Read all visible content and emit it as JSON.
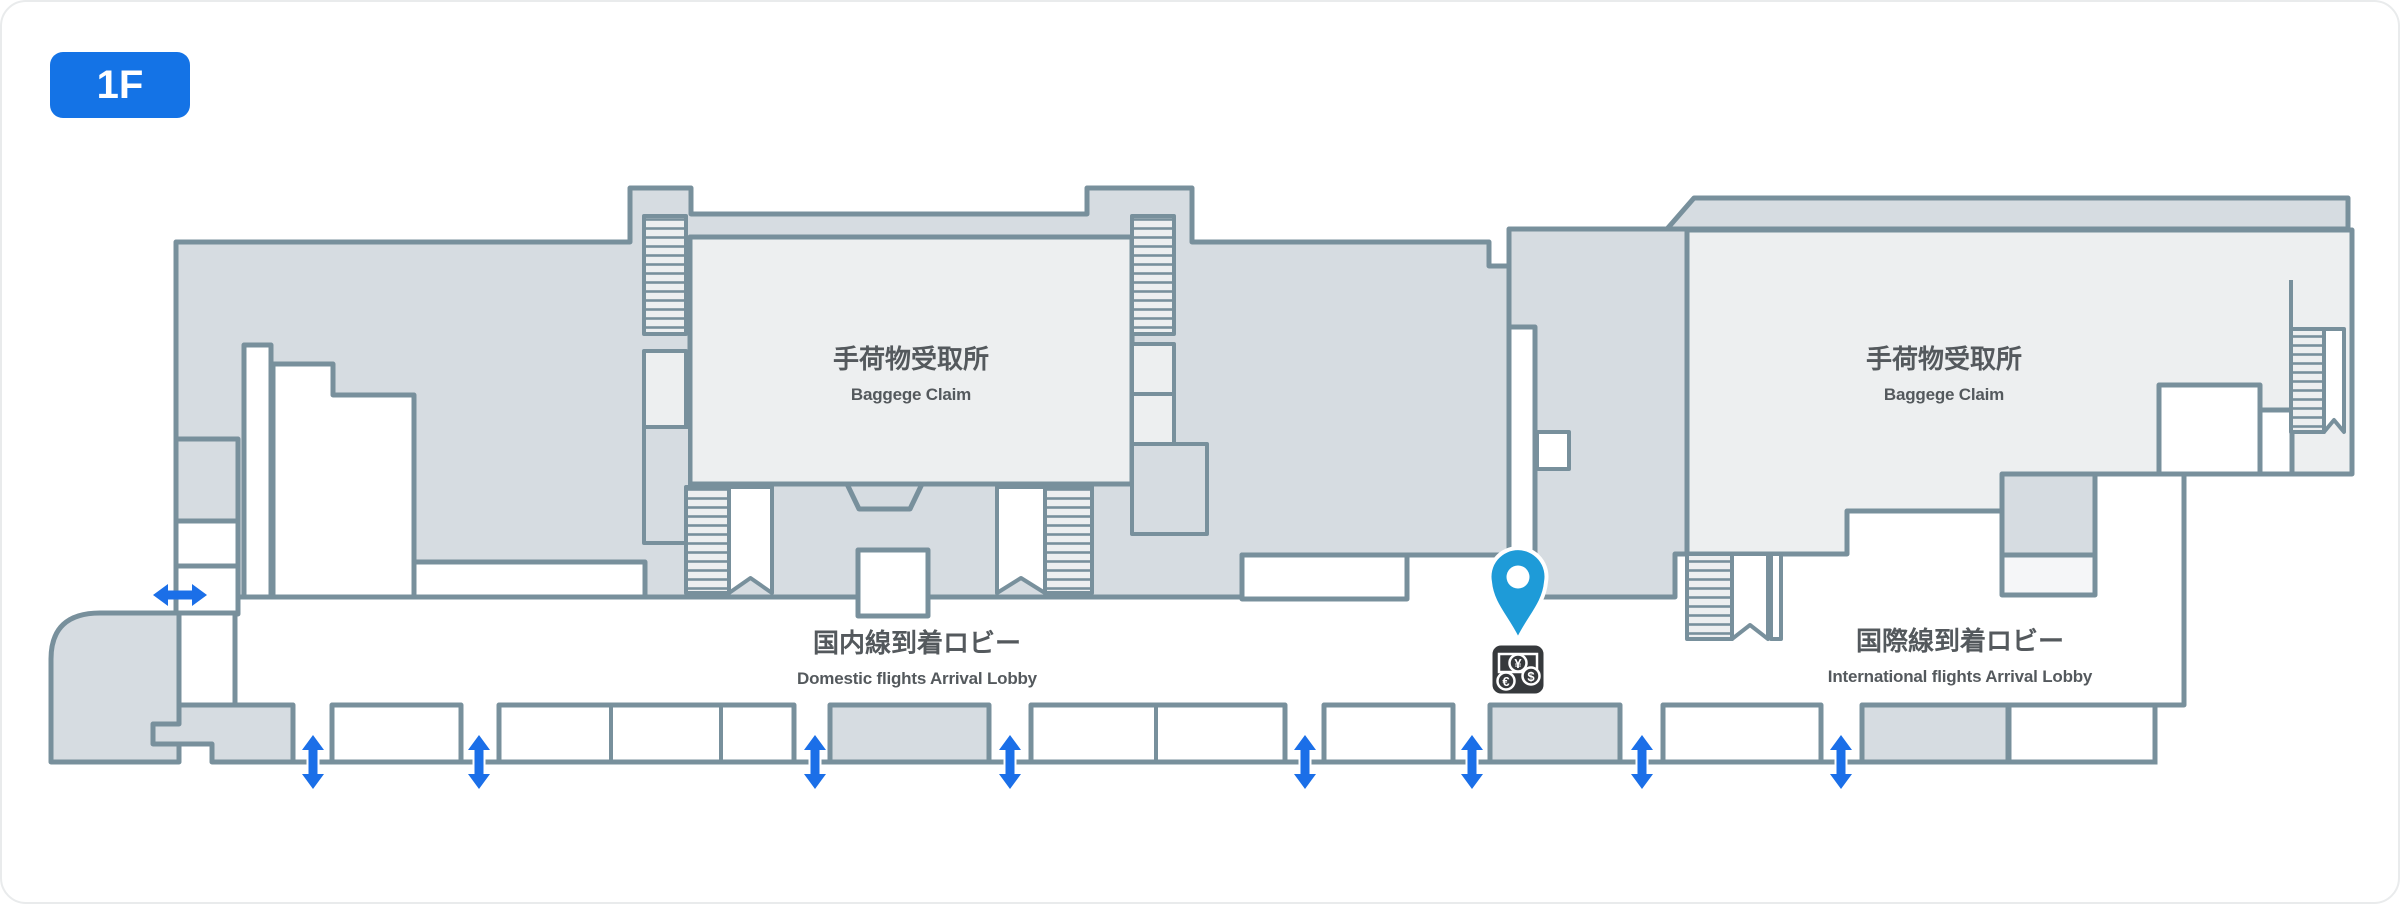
{
  "floor_badge": {
    "label": "1F"
  },
  "areas": {
    "baggage_claim_left": {
      "jp": "手荷物受取所",
      "en": "Baggege Claim"
    },
    "baggage_claim_right": {
      "jp": "手荷物受取所",
      "en": "Baggege Claim"
    },
    "domestic_lobby": {
      "jp": "国内線到着ロビー",
      "en": "Domestic flights Arrival Lobby"
    },
    "international_lobby": {
      "jp": "国際線到着ロビー",
      "en": "International flights Arrival Lobby"
    }
  },
  "marker": {
    "type": "location-pin",
    "service": "currency-exchange",
    "symbols": {
      "yen": "¥",
      "dollar": "$",
      "euro": "€"
    }
  },
  "entrances": {
    "bottom_door_arrows": 8,
    "side_door_arrows": 1
  },
  "colors": {
    "badge_blue": "#1473E6",
    "arrow_blue": "#1B6FE8",
    "pin_blue": "#1E9BD8",
    "wall_gray": "#78909C",
    "room_dark": "#D6DCE1",
    "room_light": "#EDEFF0",
    "icon_dark": "#36393C",
    "label_text": "#54595D"
  }
}
